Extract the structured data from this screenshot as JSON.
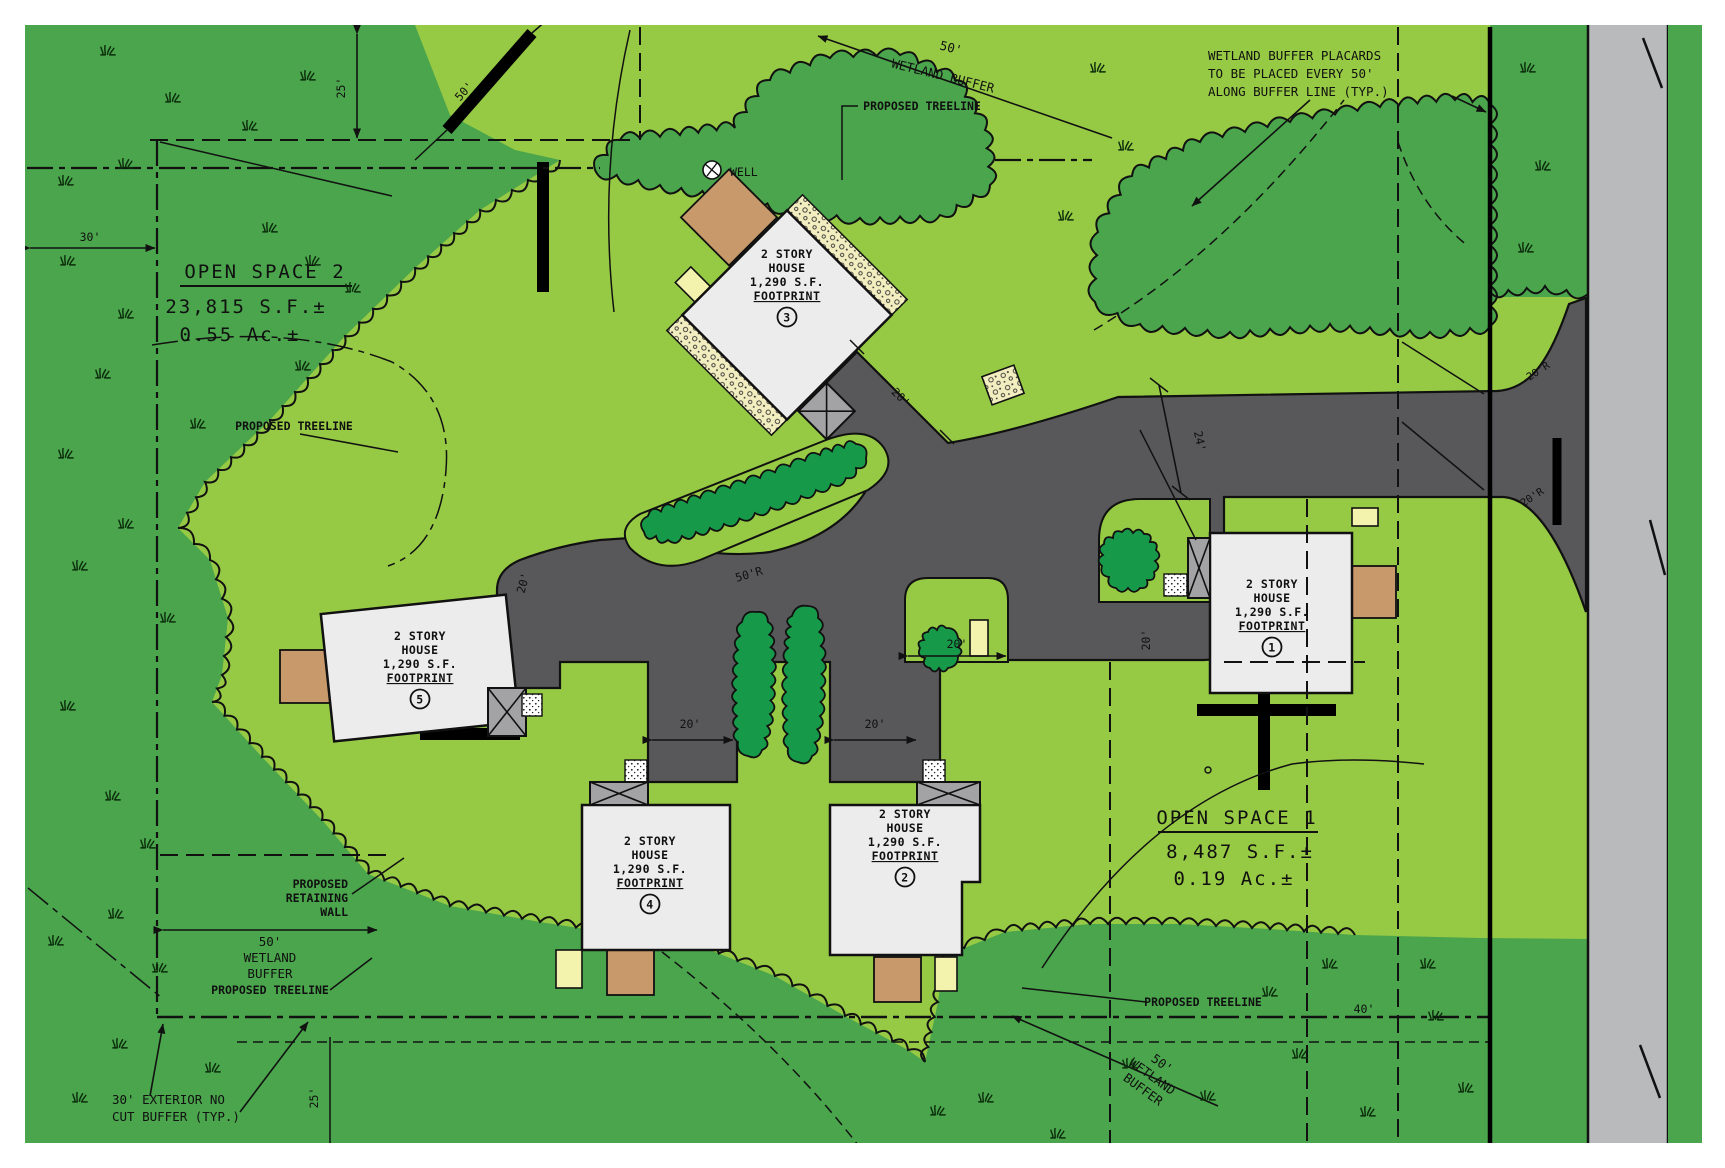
{
  "plan": {
    "open_space_2": {
      "title": "OPEN SPACE 2",
      "area_sf": "23,815 S.F.±",
      "area_ac": "0.55 Ac.±"
    },
    "open_space_1": {
      "title": "OPEN SPACE 1",
      "area_sf": "8,487 S.F.±",
      "area_ac": "0.19 Ac.±"
    },
    "houses": [
      {
        "num": "1",
        "l1": "2 STORY",
        "l2": "HOUSE",
        "l3": "1,290 S.F.",
        "l4": "FOOTPRINT"
      },
      {
        "num": "2",
        "l1": "2 STORY",
        "l2": "HOUSE",
        "l3": "1,290 S.F.",
        "l4": "FOOTPRINT"
      },
      {
        "num": "3",
        "l1": "2 STORY",
        "l2": "HOUSE",
        "l3": "1,290 S.F.",
        "l4": "FOOTPRINT"
      },
      {
        "num": "4",
        "l1": "2 STORY",
        "l2": "HOUSE",
        "l3": "1,290 S.F.",
        "l4": "FOOTPRINT"
      },
      {
        "num": "5",
        "l1": "2 STORY",
        "l2": "HOUSE",
        "l3": "1,290 S.F.",
        "l4": "FOOTPRINT"
      }
    ],
    "notes": {
      "placards_l1": "WETLAND BUFFER PLACARDS",
      "placards_l2": "TO BE PLACED EVERY 50'",
      "placards_l3": "ALONG BUFFER LINE (TYP.)",
      "proposed_treeline": "PROPOSED TREELINE",
      "well": "WELL",
      "retaining_l1": "PROPOSED",
      "retaining_l2": "RETAINING",
      "retaining_l3": "WALL",
      "wetland": "WETLAND",
      "buffer": "BUFFER",
      "wetland_buffer": "WETLAND BUFFER",
      "no_cut_l1": "30' EXTERIOR NO",
      "no_cut_l2": "CUT BUFFER (TYP.)"
    },
    "dims": {
      "d20": "20'",
      "d24": "24'",
      "d25": "25'",
      "d30": "30'",
      "d40": "40'",
      "d50": "50'",
      "r20": "20'R",
      "r50": "50'R"
    }
  },
  "colors": {
    "forest_green": "#4aa54c",
    "lawn_green": "#97ca44",
    "hedge_green": "#17994a",
    "road_gray": "#58585a",
    "street_gray": "#b9babc",
    "house_gray": "#ececec",
    "patio_tan": "#c8996b",
    "pad_yellow": "#f3f3ae",
    "stone_cream": "#f3eec0"
  }
}
